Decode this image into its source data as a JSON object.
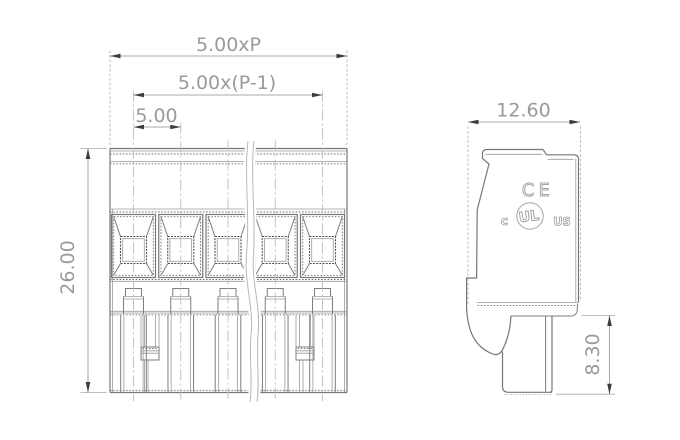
{
  "colors": {
    "dim_text": "#9a9a9a",
    "mark": "#a2a2a2",
    "line": "#7d7d7d",
    "arrow": "#3c3c3c",
    "background": "#ffffff"
  },
  "front_view": {
    "poles": 5,
    "dim_total_width": "5.00xP",
    "dim_pole_span": "5.00x(P-1)",
    "dim_pitch": "5.00",
    "dim_height": "26.00"
  },
  "side_view": {
    "dim_width": "12.60",
    "dim_pin_length": "8.30",
    "marking_ce": "CE",
    "marking_ul_c": "c",
    "marking_ul": "UL",
    "marking_ul_us": "US"
  }
}
